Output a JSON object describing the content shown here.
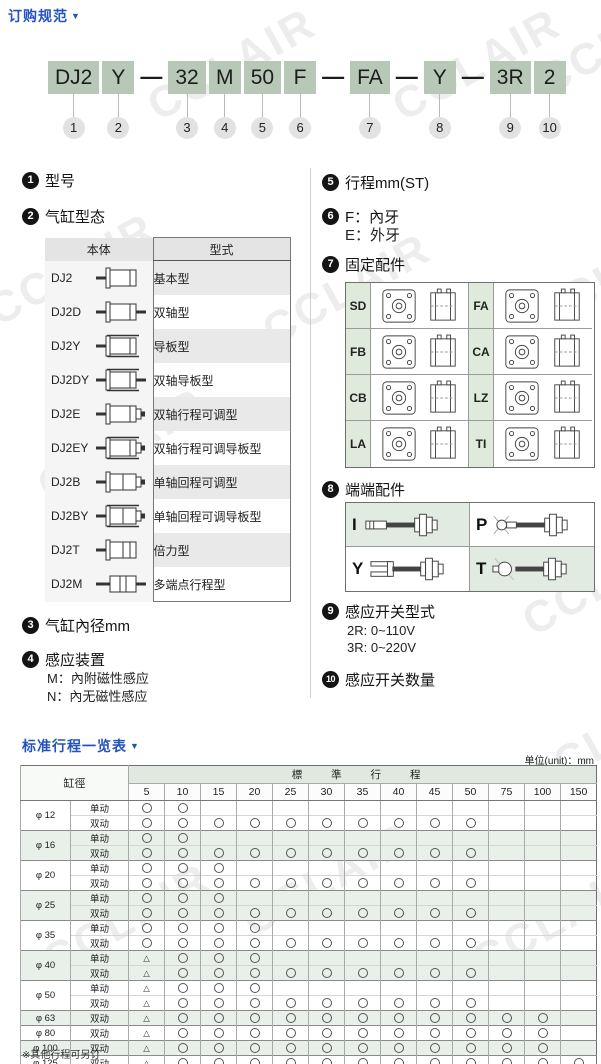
{
  "page": {
    "title": "订购规范",
    "arrow": "▼",
    "watermark": "CCLAIR"
  },
  "model_code": {
    "segments": [
      {
        "type": "box",
        "label": "DJ2",
        "num": "1"
      },
      {
        "type": "box",
        "label": "Y",
        "num": "2"
      },
      {
        "type": "dash",
        "label": "—"
      },
      {
        "type": "box",
        "label": "32",
        "num": "3"
      },
      {
        "type": "box",
        "label": "M",
        "num": "4"
      },
      {
        "type": "box",
        "label": "50",
        "num": "5"
      },
      {
        "type": "box",
        "label": "F",
        "num": "6"
      },
      {
        "type": "dash",
        "label": "—"
      },
      {
        "type": "box",
        "label": "FA",
        "num": "7"
      },
      {
        "type": "dash",
        "label": "—"
      },
      {
        "type": "box",
        "label": "Y",
        "num": "8"
      },
      {
        "type": "dash",
        "label": "—"
      },
      {
        "type": "box",
        "label": "3R",
        "num": "9"
      },
      {
        "type": "box",
        "label": "2",
        "num": "10"
      }
    ]
  },
  "sections": {
    "s1": {
      "num": "1",
      "title": "型号"
    },
    "s2": {
      "num": "2",
      "title": "气缸型态"
    },
    "s3": {
      "num": "3",
      "title": "气缸內径mm"
    },
    "s4": {
      "num": "4",
      "title": "感应装置",
      "lines": [
        "M：內附磁性感应",
        "N：內无磁性感应"
      ]
    },
    "s5": {
      "num": "5",
      "title": "行程mm(ST)"
    },
    "s6": {
      "num": "6",
      "title": "F：內牙",
      "lines": [
        "E：外牙"
      ]
    },
    "s7": {
      "num": "7",
      "title": "固定配件",
      "items": [
        "SD",
        "FA",
        "FB",
        "CA",
        "CB",
        "LZ",
        "LA",
        "TI"
      ]
    },
    "s8": {
      "num": "8",
      "title": "端端配件",
      "items": [
        "I",
        "P",
        "Y",
        "T"
      ]
    },
    "s9": {
      "num": "9",
      "title": "感应开关型式",
      "lines": [
        "2R: 0~110V",
        "3R: 0~220V"
      ]
    },
    "s10": {
      "num": "10",
      "title": "感应开关数量"
    }
  },
  "type_table": {
    "headers": [
      "本体",
      "型式"
    ],
    "rows": [
      {
        "model": "DJ2",
        "icon_kind": "basic",
        "type": "基本型"
      },
      {
        "model": "DJ2D",
        "icon_kind": "dual",
        "type": "双轴型"
      },
      {
        "model": "DJ2Y",
        "icon_kind": "guide",
        "type": "导板型"
      },
      {
        "model": "DJ2DY",
        "icon_kind": "dual-guide",
        "type": "双轴导板型"
      },
      {
        "model": "DJ2E",
        "icon_kind": "dual-adj",
        "type": "双轴行程可调型"
      },
      {
        "model": "DJ2EY",
        "icon_kind": "dual-adj-guide",
        "type": "双轴行程可调导板型"
      },
      {
        "model": "DJ2B",
        "icon_kind": "single-adj",
        "type": "单轴回程可调型"
      },
      {
        "model": "DJ2BY",
        "icon_kind": "single-adj-guide",
        "type": "单轴回程可调导板型"
      },
      {
        "model": "DJ2T",
        "icon_kind": "tandem",
        "type": "倍力型"
      },
      {
        "model": "DJ2M",
        "icon_kind": "multi",
        "type": "多端点行程型"
      }
    ]
  },
  "stroke_table": {
    "title": "标准行程一览表",
    "arrow": "▼",
    "unit": "单位(unit)：mm",
    "bore_header": "缸徑",
    "group_header": "標 準 行 程",
    "strokes": [
      "5",
      "10",
      "15",
      "20",
      "25",
      "30",
      "35",
      "40",
      "45",
      "50",
      "75",
      "100",
      "150"
    ],
    "groups": [
      {
        "bore": "φ 12",
        "rows": [
          {
            "action": "单动",
            "marks": [
              "○",
              "○",
              "",
              "",
              "",
              "",
              "",
              "",
              "",
              "",
              "",
              "",
              ""
            ]
          },
          {
            "action": "双动",
            "marks": [
              "○",
              "○",
              "○",
              "○",
              "○",
              "○",
              "○",
              "○",
              "○",
              "○",
              "",
              "",
              ""
            ]
          }
        ]
      },
      {
        "bore": "φ 16",
        "rows": [
          {
            "action": "单动",
            "marks": [
              "○",
              "○",
              "",
              "",
              "",
              "",
              "",
              "",
              "",
              "",
              "",
              "",
              ""
            ]
          },
          {
            "action": "双动",
            "marks": [
              "○",
              "○",
              "○",
              "○",
              "○",
              "○",
              "○",
              "○",
              "○",
              "○",
              "",
              "",
              ""
            ]
          }
        ]
      },
      {
        "bore": "φ 20",
        "rows": [
          {
            "action": "单动",
            "marks": [
              "○",
              "○",
              "○",
              "",
              "",
              "",
              "",
              "",
              "",
              "",
              "",
              "",
              ""
            ]
          },
          {
            "action": "双动",
            "marks": [
              "○",
              "○",
              "○",
              "○",
              "○",
              "○",
              "○",
              "○",
              "○",
              "○",
              "",
              "",
              ""
            ]
          }
        ]
      },
      {
        "bore": "φ 25",
        "rows": [
          {
            "action": "单动",
            "marks": [
              "○",
              "○",
              "○",
              "",
              "",
              "",
              "",
              "",
              "",
              "",
              "",
              "",
              ""
            ]
          },
          {
            "action": "双动",
            "marks": [
              "○",
              "○",
              "○",
              "○",
              "○",
              "○",
              "○",
              "○",
              "○",
              "○",
              "",
              "",
              ""
            ]
          }
        ]
      },
      {
        "bore": "φ 35",
        "rows": [
          {
            "action": "单动",
            "marks": [
              "○",
              "○",
              "○",
              "○",
              "",
              "",
              "",
              "",
              "",
              "",
              "",
              "",
              ""
            ]
          },
          {
            "action": "双动",
            "marks": [
              "○",
              "○",
              "○",
              "○",
              "○",
              "○",
              "○",
              "○",
              "○",
              "○",
              "",
              "",
              ""
            ]
          }
        ]
      },
      {
        "bore": "φ 40",
        "rows": [
          {
            "action": "单动",
            "marks": [
              "△",
              "○",
              "○",
              "○",
              "",
              "",
              "",
              "",
              "",
              "",
              "",
              "",
              ""
            ]
          },
          {
            "action": "双动",
            "marks": [
              "△",
              "○",
              "○",
              "○",
              "○",
              "○",
              "○",
              "○",
              "○",
              "○",
              "",
              "",
              ""
            ]
          }
        ]
      },
      {
        "bore": "φ 50",
        "rows": [
          {
            "action": "单动",
            "marks": [
              "△",
              "○",
              "○",
              "○",
              "",
              "",
              "",
              "",
              "",
              "",
              "",
              "",
              ""
            ]
          },
          {
            "action": "双动",
            "marks": [
              "△",
              "○",
              "○",
              "○",
              "○",
              "○",
              "○",
              "○",
              "○",
              "○",
              "",
              "",
              ""
            ]
          }
        ]
      },
      {
        "bore": "φ 63",
        "rows": [
          {
            "action": "双动",
            "marks": [
              "△",
              "○",
              "○",
              "○",
              "○",
              "○",
              "○",
              "○",
              "○",
              "○",
              "○",
              "○",
              ""
            ]
          }
        ]
      },
      {
        "bore": "φ 80",
        "rows": [
          {
            "action": "双动",
            "marks": [
              "△",
              "○",
              "○",
              "○",
              "○",
              "○",
              "○",
              "○",
              "○",
              "○",
              "○",
              "○",
              ""
            ]
          }
        ]
      },
      {
        "bore": "φ 100",
        "rows": [
          {
            "action": "双动",
            "marks": [
              "△",
              "○",
              "○",
              "○",
              "○",
              "○",
              "○",
              "○",
              "○",
              "○",
              "○",
              "○",
              ""
            ]
          }
        ]
      },
      {
        "bore": "φ 125",
        "rows": [
          {
            "action": "双动",
            "marks": [
              "△",
              "○",
              "○",
              "○",
              "○",
              "○",
              "○",
              "○",
              "○",
              "○",
              "○",
              "○",
              "○"
            ]
          }
        ]
      },
      {
        "bore": "φ 160",
        "rows": [
          {
            "action": "双动",
            "marks": [
              "△",
              "○",
              "○",
              "○",
              "○",
              "○",
              "○",
              "○",
              "○",
              "○",
              "○",
              "○",
              "○"
            ]
          }
        ]
      },
      {
        "bore": "φ 200",
        "rows": [
          {
            "action": "双动",
            "marks": [
              "△",
              "○",
              "○",
              "○",
              "○",
              "○",
              "○",
              "○",
              "○",
              "○",
              "○",
              "○",
              "○"
            ]
          }
        ]
      }
    ],
    "footnote": "※其他行程可另订"
  }
}
